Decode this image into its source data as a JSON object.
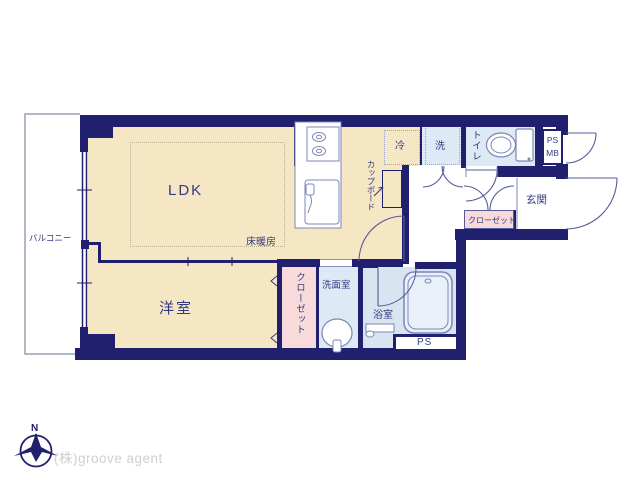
{
  "plan": {
    "rooms": {
      "ldk": {
        "label": "LDK"
      },
      "floor_heating": {
        "label": "床暖房"
      },
      "bedroom": {
        "label": "洋室"
      },
      "balcony": {
        "label": "バルコニー"
      },
      "bedroom_closet": {
        "label": "クローゼット"
      },
      "hall_closet": {
        "label": "クローゼット"
      },
      "washroom": {
        "label": "洗面室"
      },
      "bathroom": {
        "label": "浴室"
      },
      "toilet": {
        "label": "トイレ"
      },
      "entrance": {
        "label": "玄関"
      },
      "pipe_space": {
        "label": "PS"
      },
      "ps_mb": {
        "line1": "PS",
        "line2": "MB"
      },
      "fridge": {
        "label": "冷"
      },
      "washer": {
        "label": "洗"
      },
      "cupboard": {
        "label": "カップボード"
      }
    },
    "compass": {
      "north_label": "N"
    },
    "branding": {
      "company": "(株)groove agent"
    },
    "colors": {
      "wall": "#20206e",
      "room_beige": "#f6e7c4",
      "room_blue": "#dde9f4",
      "room_pink": "#f9dada",
      "label_text": "#333a80",
      "fixture_line": "#7c86b8",
      "door_arc": "#565b9b",
      "balcony_line": "#9aa0b0",
      "company_text": "#cfcfcf"
    }
  }
}
